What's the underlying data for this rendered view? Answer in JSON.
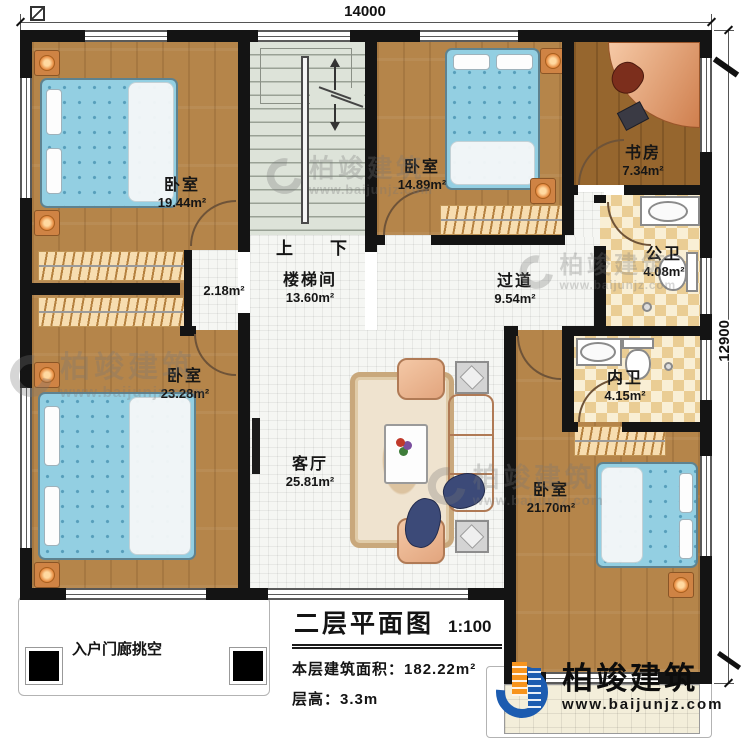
{
  "dimensions": {
    "top": "14000",
    "right": "12900"
  },
  "stairs": {
    "up": "上",
    "down": "下"
  },
  "rooms": [
    {
      "id": "bedroom-top-left",
      "name": "卧室",
      "area": "19.44m²"
    },
    {
      "id": "bedroom-top-middle",
      "name": "卧室",
      "area": "14.89m²"
    },
    {
      "id": "study",
      "name": "书房",
      "area": "7.34m²"
    },
    {
      "id": "public-bathroom",
      "name": "公卫",
      "area": "4.08m²"
    },
    {
      "id": "hallway",
      "name": "过道",
      "area": "9.54m²"
    },
    {
      "id": "stairwell",
      "name": "楼梯间",
      "area": "13.60m²"
    },
    {
      "id": "nook",
      "name": "",
      "area": "2.18m²"
    },
    {
      "id": "bedroom-bottom-left",
      "name": "卧室",
      "area": "23.28m²"
    },
    {
      "id": "ensuite-bathroom",
      "name": "内卫",
      "area": "4.15m²"
    },
    {
      "id": "living-room",
      "name": "客厅",
      "area": "25.81m²"
    },
    {
      "id": "bedroom-bottom-right",
      "name": "卧室",
      "area": "21.70m²"
    }
  ],
  "title_block": {
    "title": "二层平面图",
    "scale": "1:100",
    "area_label": "本层建筑面积：",
    "area_value": "182.22m²",
    "height_label": "层高：",
    "height_value": "3.3m"
  },
  "annotations": {
    "porch": "入户门廊挑空"
  },
  "branding": {
    "name": "柏竣建筑",
    "website": "www.baijunjz.com"
  },
  "colors": {
    "wall": "#141414",
    "wood": "#b5854a",
    "wood_dark": "#96662e",
    "tile": "#f5f6f3",
    "bath_tile": "#eacd94",
    "bed": "#93cfe2",
    "stair": "#dde3d9",
    "logo_blue": "#1c5cb0",
    "logo_orange": "#f7941d"
  }
}
